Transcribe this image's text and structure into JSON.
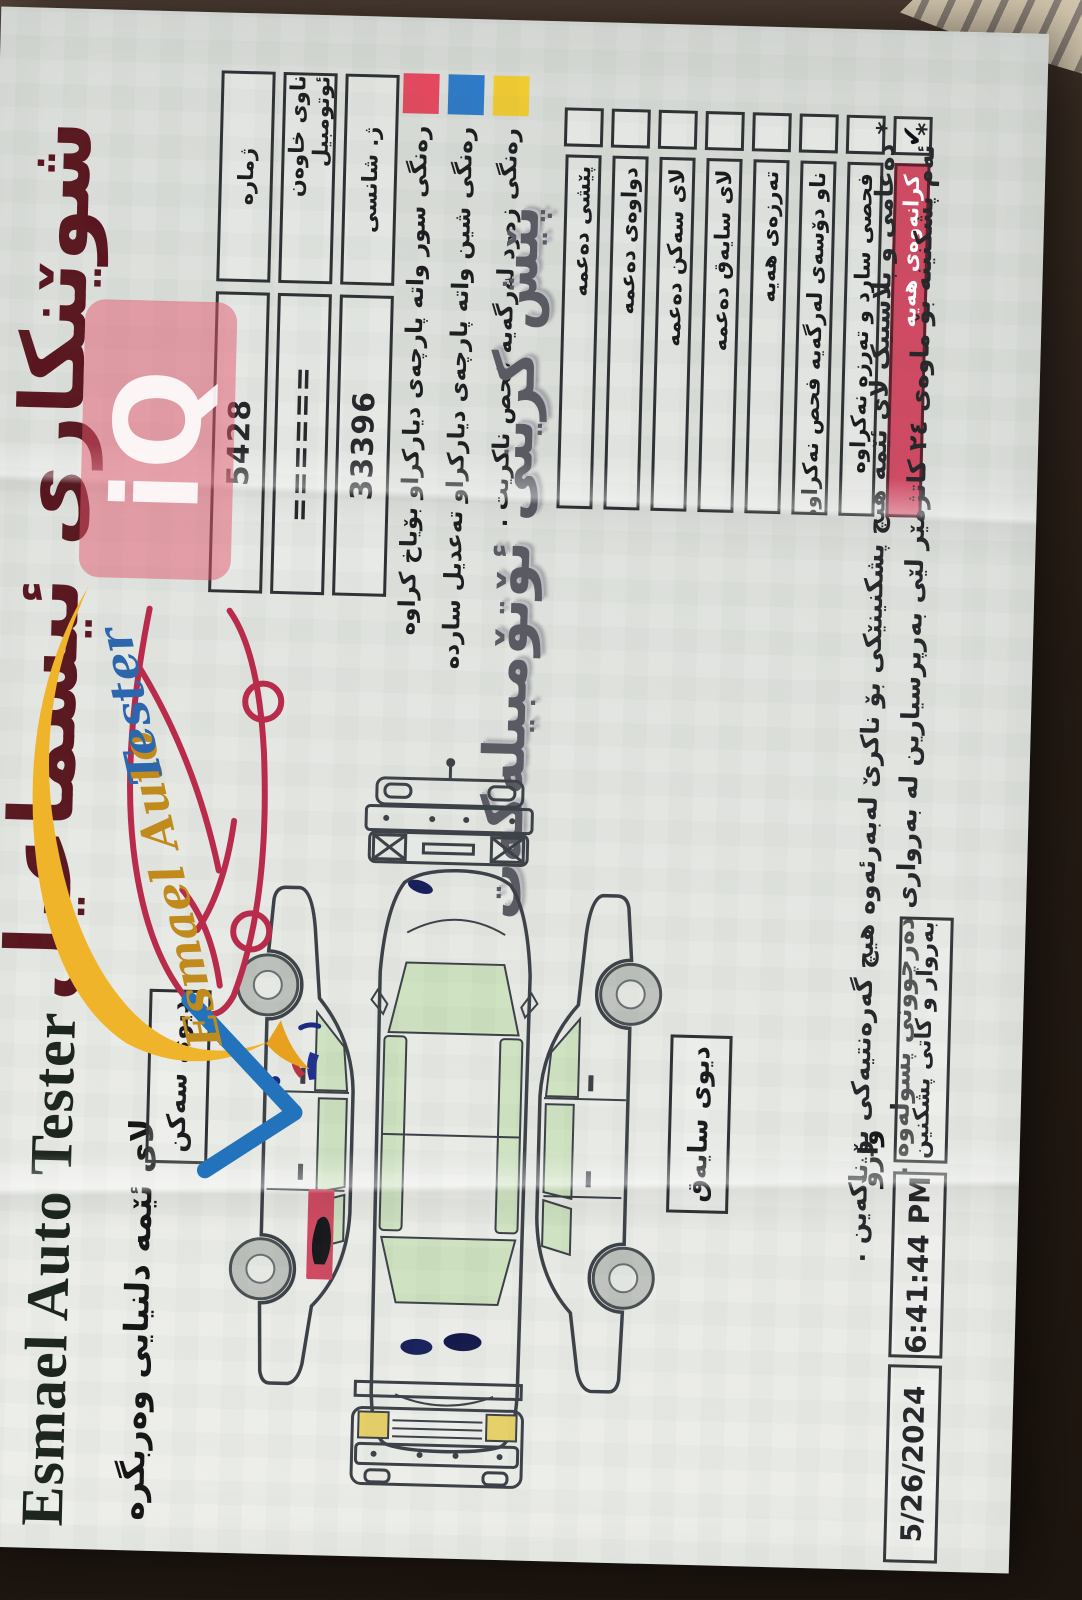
{
  "colors": {
    "title_maroon": "#5a1620",
    "legend_red": "#e4485f",
    "legend_blue": "#2e7ac8",
    "legend_yellow": "#f1cb32",
    "checked_row_bg": "#cf4a63",
    "paper": "#e7e9e5"
  },
  "watermark": {
    "text": "iQ"
  },
  "header": {
    "title": "شوێنکاری ئیسماعیل",
    "subtitle": "پێش کرینی ئۆتۆمبیلەکەت",
    "brand_serif": "Esmael Auto Tester",
    "slogan": "لای ئێمه دلنیایی وەربگره",
    "logo_script_gold": "Esmael Auto",
    "logo_script_blue": "Tester"
  },
  "form": {
    "fields": [
      {
        "label": "ژماره",
        "value": "5428"
      },
      {
        "label": "ناوی خاوەن ئوتومبیل",
        "value": "======"
      },
      {
        "label": "ژ. شانسی",
        "value": "33396"
      }
    ]
  },
  "legend": {
    "items": [
      {
        "color": "#e4485f",
        "text": "رەنگی سور واته پارچەی دیارکراو بۆیاخ کراوه"
      },
      {
        "color": "#2e7ac8",
        "text": "رەنگی شین واته پارچەی دیارکراو تەعدیل سارده"
      },
      {
        "color": "#f1cb32",
        "text": "رەنگی زەرد لەرگەیه فحص ناکریت ."
      }
    ]
  },
  "checklist": {
    "items": [
      {
        "text": "پێشی دەعمه",
        "checked": false,
        "mark": ""
      },
      {
        "text": "دواوەی دەعمه",
        "checked": false,
        "mark": ""
      },
      {
        "text": "لای سەکن دەعمه",
        "checked": false,
        "mark": ""
      },
      {
        "text": "لای سایەق دەعمه",
        "checked": false,
        "mark": ""
      },
      {
        "text": "تەرزەی هەیه",
        "checked": false,
        "mark": ""
      },
      {
        "text": "ناو دۆسەی لەرگەیه فحص نەکراوه",
        "checked": false,
        "mark": ""
      },
      {
        "text": "فحصی سارد و تەرزە نەکراوه",
        "checked": false,
        "mark": ""
      },
      {
        "text": "کرانەوەی هەیه",
        "checked": true,
        "mark": "✔"
      }
    ]
  },
  "diagram": {
    "side_top_label": "دیوی سەکن",
    "side_bottom_label": "دیوی سایەق"
  },
  "footnotes": {
    "line1": "* دەعامی و پلاستیک لای ئێمه هیچ پشکنینێکی بۆ ناکرێ لەبەرئەوە هیچ گەرەنتیەکی بۆ ناکەین .",
    "line2": "* ئەم پشکنینه بۆ ماوەی ٢٤ کاتژمێر لێی بەرپرسیارین له بەرواری دەرچوونی پسولەوە ."
  },
  "footer": {
    "signature_label": "واژۆ",
    "datetime_label": "بەروار و کاتی پشکنین",
    "time": "6:41:44 PM",
    "date": "5/26/2024"
  }
}
